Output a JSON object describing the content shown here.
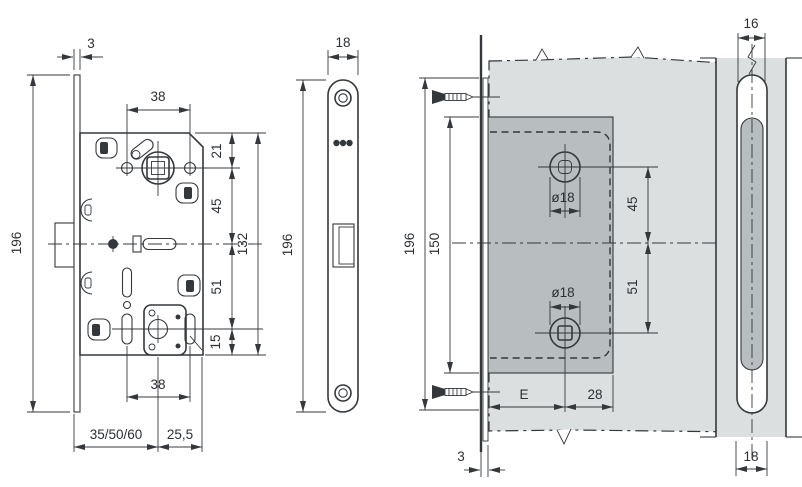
{
  "palette": {
    "line_color": "#34383b",
    "text_color": "#2c3034",
    "door_fill": "#dcdfe0",
    "mortise_fill": "#b8bdbf",
    "background": "#ffffff"
  },
  "views": {
    "lock_front": {
      "name": "mortise-lock-body-front-view",
      "dims": {
        "faceplate_thickness": "3",
        "overall_height": "196",
        "top_hole_spacing": "38",
        "top_to_handle": "21",
        "handle_to_center": "45",
        "body_height": "132",
        "center_to_spindle": "51",
        "spindle_to_bottom": "15",
        "bottom_hole_spacing": "38",
        "backset_options": "35/50/60",
        "rear_depth": "25,5"
      }
    },
    "faceplate": {
      "name": "faceplate-front-view",
      "dims": {
        "width": "18",
        "height": "196"
      }
    },
    "door_mounting": {
      "name": "door-mounting-layout-view",
      "dims": {
        "faceplate_height": "196",
        "mortise_height": "150",
        "upper_hole_diameter": "ø18",
        "lower_hole_diameter": "ø18",
        "upper_to_center": "45",
        "center_to_lower": "51",
        "backset": "E",
        "rear_distance": "28",
        "faceplate_thickness": "3"
      }
    },
    "door_edge": {
      "name": "door-edge-slot-view",
      "dims": {
        "slot_width": "16",
        "faceplate_slot_width": "18"
      }
    }
  }
}
